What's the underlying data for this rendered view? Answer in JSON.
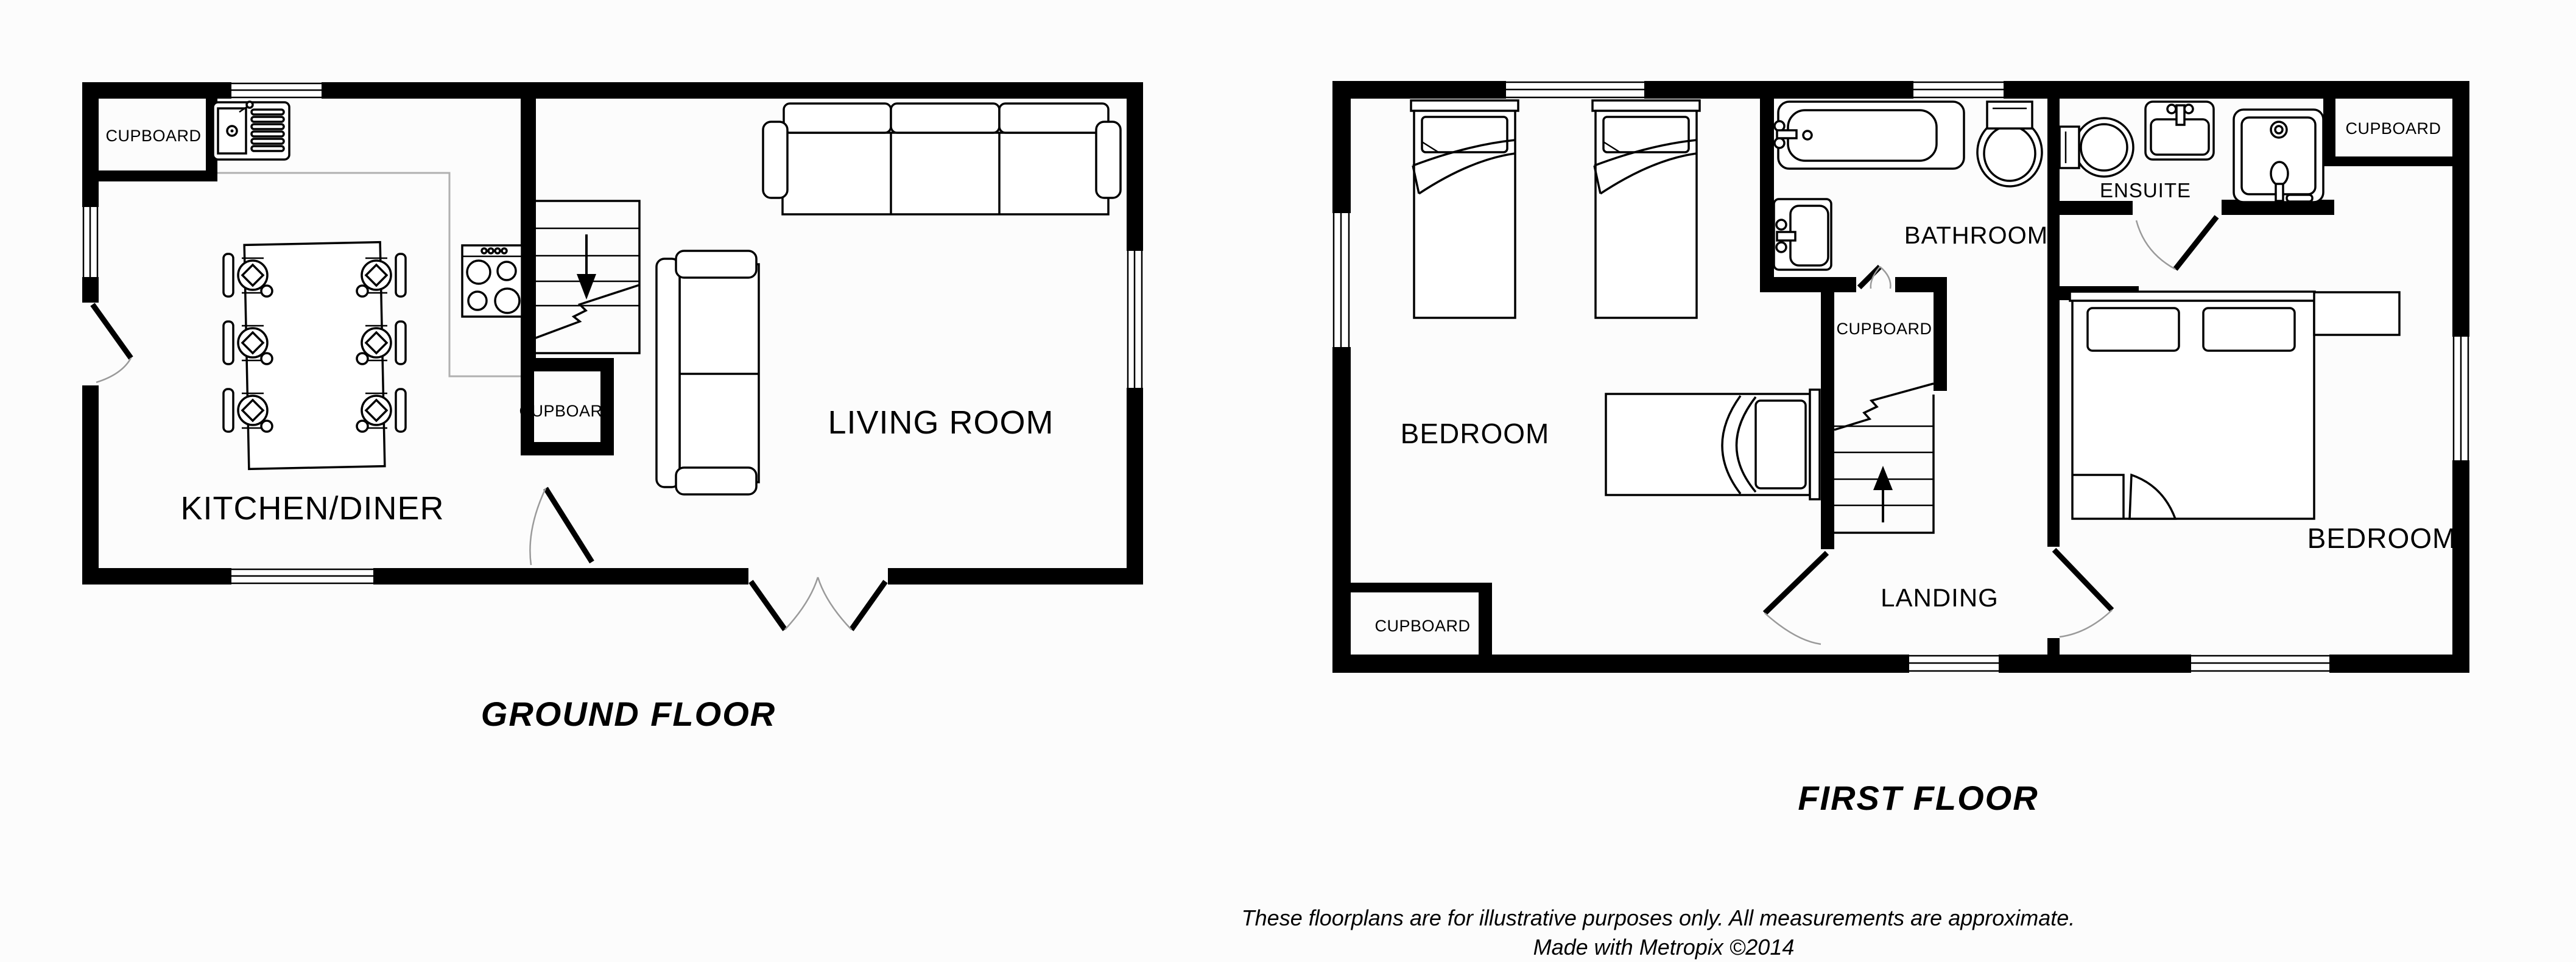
{
  "ground_floor": {
    "title": "GROUND FLOOR",
    "labels": {
      "cupboard_top_left": "CUPBOARD",
      "kitchen_diner": "KITCHEN/DINER",
      "cupboard_middle": "CUPBOARD",
      "living_room": "LIVING ROOM"
    }
  },
  "first_floor": {
    "title": "FIRST FLOOR",
    "labels": {
      "bedroom_left": "BEDROOM",
      "bedroom_right": "BEDROOM",
      "bathroom": "BATHROOM",
      "ensuite": "ENSUITE",
      "landing": "LANDING",
      "cupboard_bottom_left": "CUPBOARD",
      "cupboard_middle": "CUPBOARD",
      "cupboard_top_right": "CUPBOARD"
    }
  },
  "footer": {
    "disclaimer": "These floorplans are for illustrative purposes only. All measurements are approximate.",
    "credit": "Made with Metropix ©2014"
  },
  "colors": {
    "wall": "#000000",
    "furniture_line": "#000000",
    "counter_line": "#b0b0b0",
    "door_arc": "#9a9a9a",
    "background": "#fcfcfc"
  }
}
